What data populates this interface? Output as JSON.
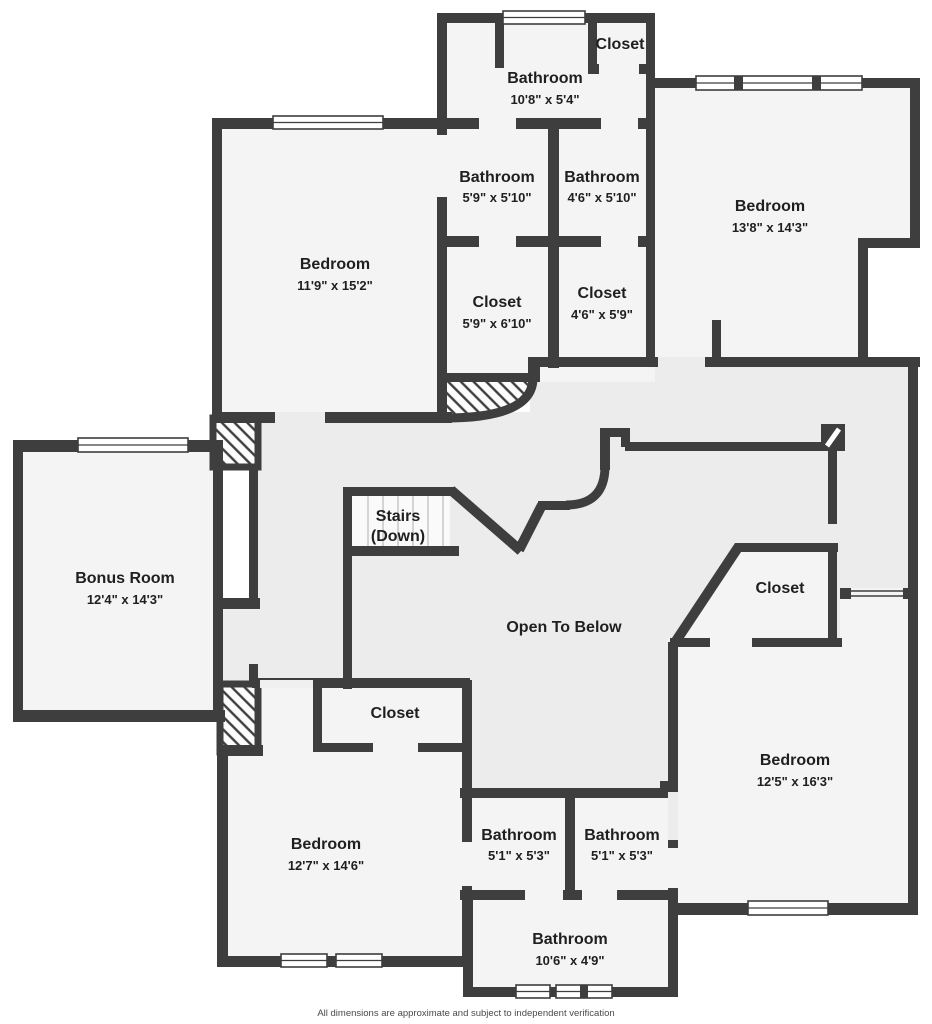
{
  "plan": {
    "rooms": {
      "closet_top": {
        "label": "Closet",
        "dims": ""
      },
      "bathroom_top": {
        "label": "Bathroom",
        "dims": "10'8\" x 5'4\""
      },
      "bathroom_59": {
        "label": "Bathroom",
        "dims": "5'9\" x 5'10\""
      },
      "bathroom_46": {
        "label": "Bathroom",
        "dims": "4'6\" x 5'10\""
      },
      "bedroom_tr": {
        "label": "Bedroom",
        "dims": "13'8\" x 14'3\""
      },
      "bedroom_tl": {
        "label": "Bedroom",
        "dims": "11'9\" x 15'2\""
      },
      "closet_59": {
        "label": "Closet",
        "dims": "5'9\" x 6'10\""
      },
      "closet_46": {
        "label": "Closet",
        "dims": "4'6\" x 5'9\""
      },
      "bonus_room": {
        "label": "Bonus Room",
        "dims": "12'4\" x 14'3\""
      },
      "closet_right": {
        "label": "Closet",
        "dims": ""
      },
      "closet_bottom": {
        "label": "Closet",
        "dims": ""
      },
      "bedroom_br": {
        "label": "Bedroom",
        "dims": "12'5\" x 16'3\""
      },
      "bedroom_bl": {
        "label": "Bedroom",
        "dims": "12'7\" x 14'6\""
      },
      "bathroom_b1": {
        "label": "Bathroom",
        "dims": "5'1\" x 5'3\""
      },
      "bathroom_b2": {
        "label": "Bathroom",
        "dims": "5'1\" x 5'3\""
      },
      "bathroom_bot": {
        "label": "Bathroom",
        "dims": "10'6\" x 4'9\""
      }
    },
    "stairs": {
      "label": "Stairs",
      "sublabel": "(Down)"
    },
    "open_area": {
      "label": "Open To Below"
    },
    "footer": {
      "disclaimer": "All dimensions are approximate and subject to independent verification"
    },
    "colors": {
      "wall": "#3e3e3e",
      "room_floor": "#f4f4f4",
      "hall_floor": "#ececec",
      "background": "#ffffff"
    }
  }
}
